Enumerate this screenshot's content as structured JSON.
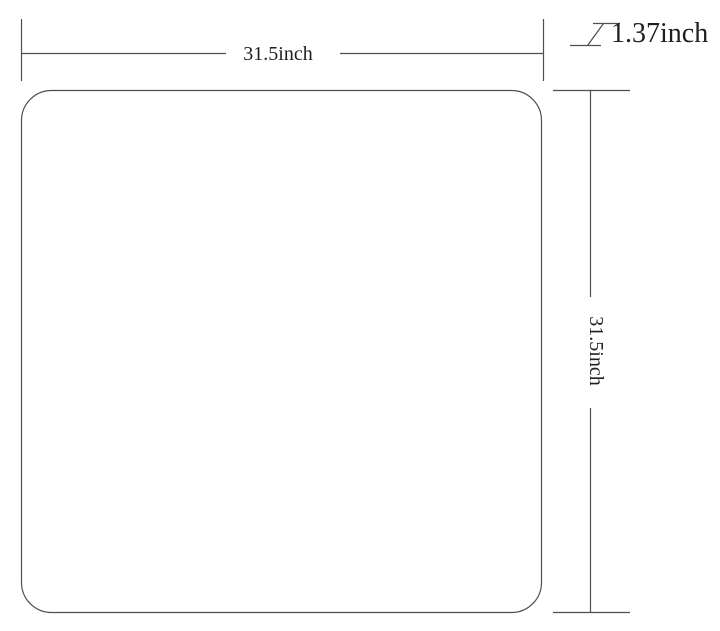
{
  "diagram": {
    "type": "product-dimension-drawing",
    "background_color": "#ffffff",
    "line_color": "#4f4f4f",
    "text_color": "#1f1f1f",
    "shape": {
      "name": "rounded-square-panel",
      "corner_style": "rounded"
    },
    "dimensions": {
      "width": {
        "label": "31.5inch",
        "value": 31.5,
        "unit": "inch"
      },
      "height": {
        "label": "31.5inch",
        "value": 31.5,
        "unit": "inch"
      },
      "thickness": {
        "label": "1.37inch",
        "value": 1.37,
        "unit": "inch",
        "symbol": "z-thickness-mark"
      }
    }
  }
}
